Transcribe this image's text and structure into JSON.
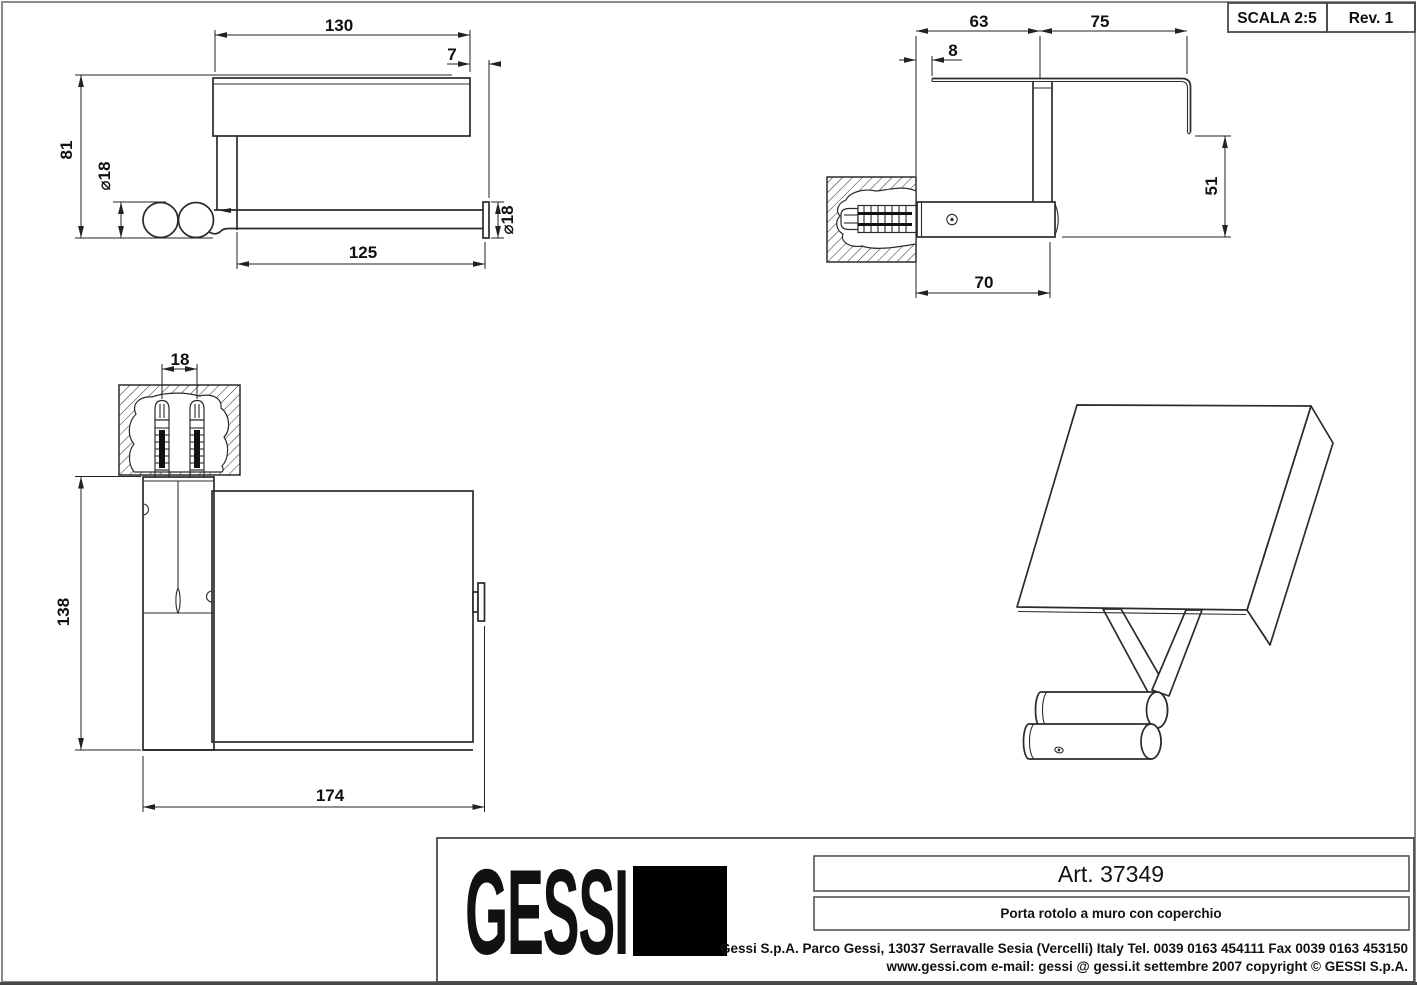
{
  "sheet": {
    "scale_label": "SCALA 2:5",
    "rev_label": "Rev. 1",
    "colors": {
      "ink": "#1c1c1c",
      "frame": "#8a8a8a",
      "background": "#ffffff"
    }
  },
  "title_block": {
    "logo_text": "GESSI",
    "art_number": "Art. 37349",
    "description": "Porta rotolo a muro con coperchio",
    "address_line1": "Gessi S.p.A. Parco Gessi, 13037 Serravalle Sesia (Vercelli) Italy Tel. 0039  0163 454111 Fax 0039 0163 453150",
    "address_line2": "www.gessi.com e-mail: gessi @ gessi.it settembre 2007 copyright © GESSI S.p.A."
  },
  "views": {
    "front": {
      "name": "front-elevation",
      "dims": {
        "lid_width": "130",
        "lid_overhang": "7",
        "overall_height": "81",
        "roller_diameter": "⌀18",
        "bar_length": "125",
        "end_cap_diameter": "⌀18"
      }
    },
    "side": {
      "name": "side-section",
      "dims": {
        "wall_to_post": "63",
        "post_to_front": "75",
        "wall_clearance": "8",
        "flap_drop": "51",
        "arm_length": "70"
      }
    },
    "plan": {
      "name": "top-plan",
      "dims": {
        "anchor_spacing": "18",
        "overall_depth": "138",
        "overall_width": "174"
      }
    },
    "isometric": {
      "name": "isometric-projection"
    }
  }
}
